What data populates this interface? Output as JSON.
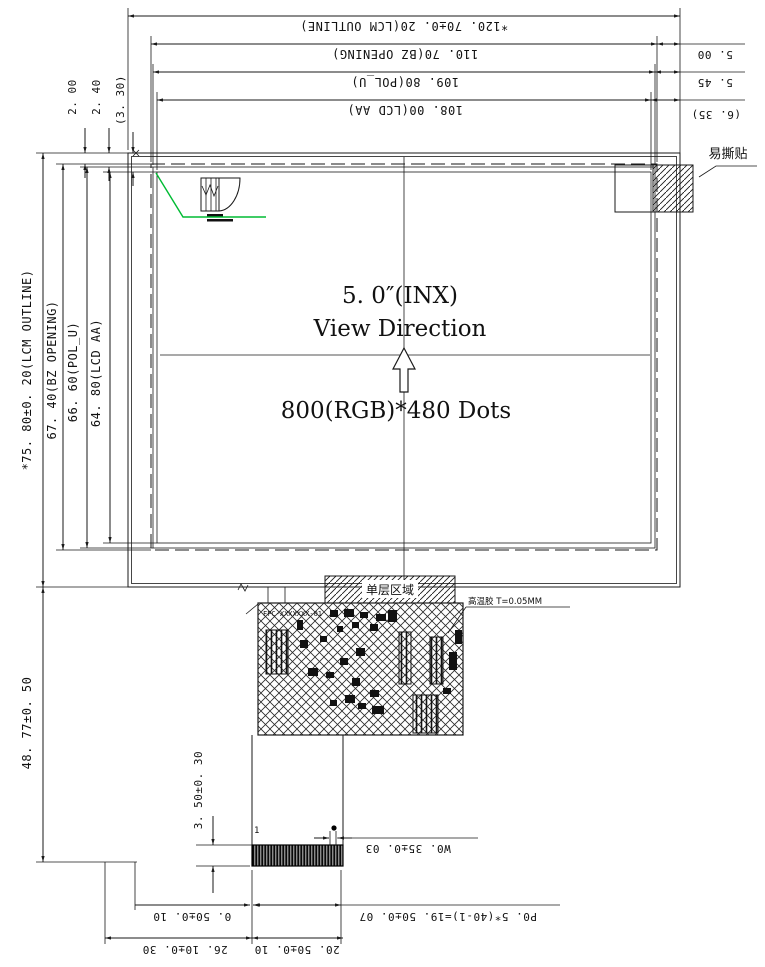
{
  "drawing": {
    "center": {
      "size_label": "5. 0″(INX)",
      "view_direction": "View Direction",
      "resolution": "800(RGB)*480 Dots"
    },
    "dims_top": {
      "lcm_outline": "*120. 70±0. 20(LCM OUTLINE)",
      "bz_opening": "110. 70(BZ OPENING)",
      "pol_u": "109. 80(POL_U)",
      "lcd_aa": "108. 00(LCD AA)"
    },
    "dims_right": {
      "d1": "5. 00",
      "d2": "5. 45",
      "d3": "(6. 35)"
    },
    "dims_left": {
      "lcm_outline": "*75. 80±0. 20(LCM OUTLINE)",
      "bz_opening": "67. 40(BZ OPENING)",
      "pol_u": "66. 60(POL_U)",
      "lcd_aa": "64. 80(LCD AA)",
      "t1": "2. 00",
      "t2": "2. 40",
      "t3": "(3. 30)",
      "fpc_drop": "48. 77±0. 50",
      "finger_len": "3. 50±0. 30"
    },
    "dims_bottom": {
      "finger_width": "W0. 35±0. 03",
      "pitch": "P0. 5*(40-1)=19. 50±0. 07",
      "gap": "0. 50±0. 10",
      "tail_width": "20. 50±0. 10",
      "offset": "26. 10±0. 30"
    },
    "labels": {
      "tear_sticker": "易撕贴",
      "single_layer_area": "单层区域",
      "adhesive": "高温胶 T=0.05MM",
      "fpc_silk": "FPC-XXXXXXX-01",
      "pin1": "1"
    }
  },
  "colors": {
    "line": "#1a1a1a",
    "leader_green": "#00bb33"
  }
}
